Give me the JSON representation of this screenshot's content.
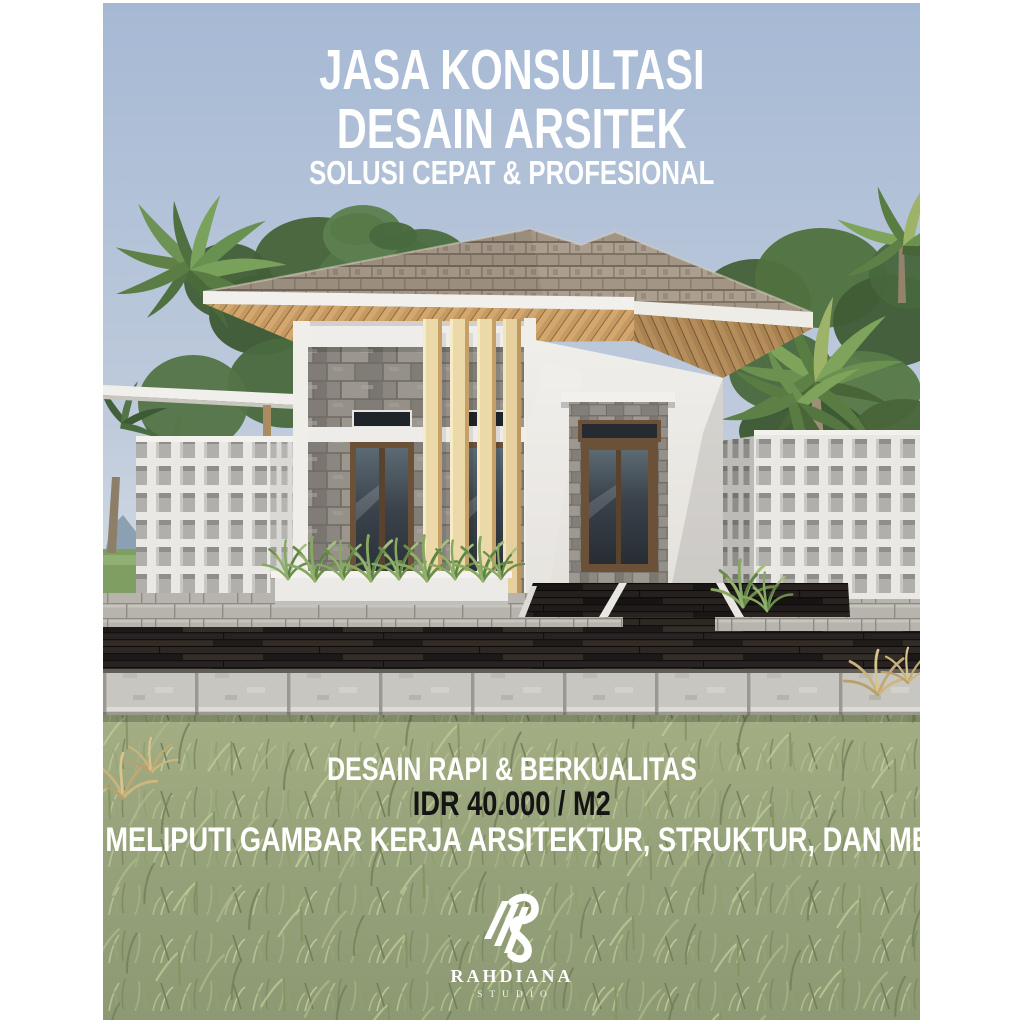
{
  "poster": {
    "headline": {
      "line1": "JASA KONSULTASI",
      "line2": "DESAIN ARSITEK",
      "subtitle": "SOLUSI CEPAT & PROFESIONAL"
    },
    "footer": {
      "tagline": "DESAIN RAPI & BERKUALITAS",
      "price": "IDR 40.000 / M2",
      "scope": "MELIPUTI GAMBAR KERJA ARSITEKTUR, STRUKTUR, DAN MEP"
    },
    "brand": {
      "name": "RAHDIANA",
      "subname": "STUDIO",
      "logo_icon": "rahdiana-r-monogram-icon"
    },
    "scene": {
      "subject": "modern minimalist tropical house 3D render with palm trees, breeze-block fences, wood deck and lawn"
    },
    "colors": {
      "canvas_margin": "#ffffff",
      "sky_top": "#a6b9d4",
      "sky_horizon": "#d4dbe4",
      "grass": "#9aa67e",
      "roof_shingle": "#a39584",
      "wood_soffit": "#c59a62",
      "stone_cladding": "#8f8b84",
      "louver_wood": "#ecd9a9",
      "window_frame": "#6a5137",
      "deck_wood": "#262120",
      "paver": "#c8c6c0",
      "fence_white": "#e9e8e5",
      "headline_text": "#ffffff",
      "price_text": "#141414"
    }
  }
}
